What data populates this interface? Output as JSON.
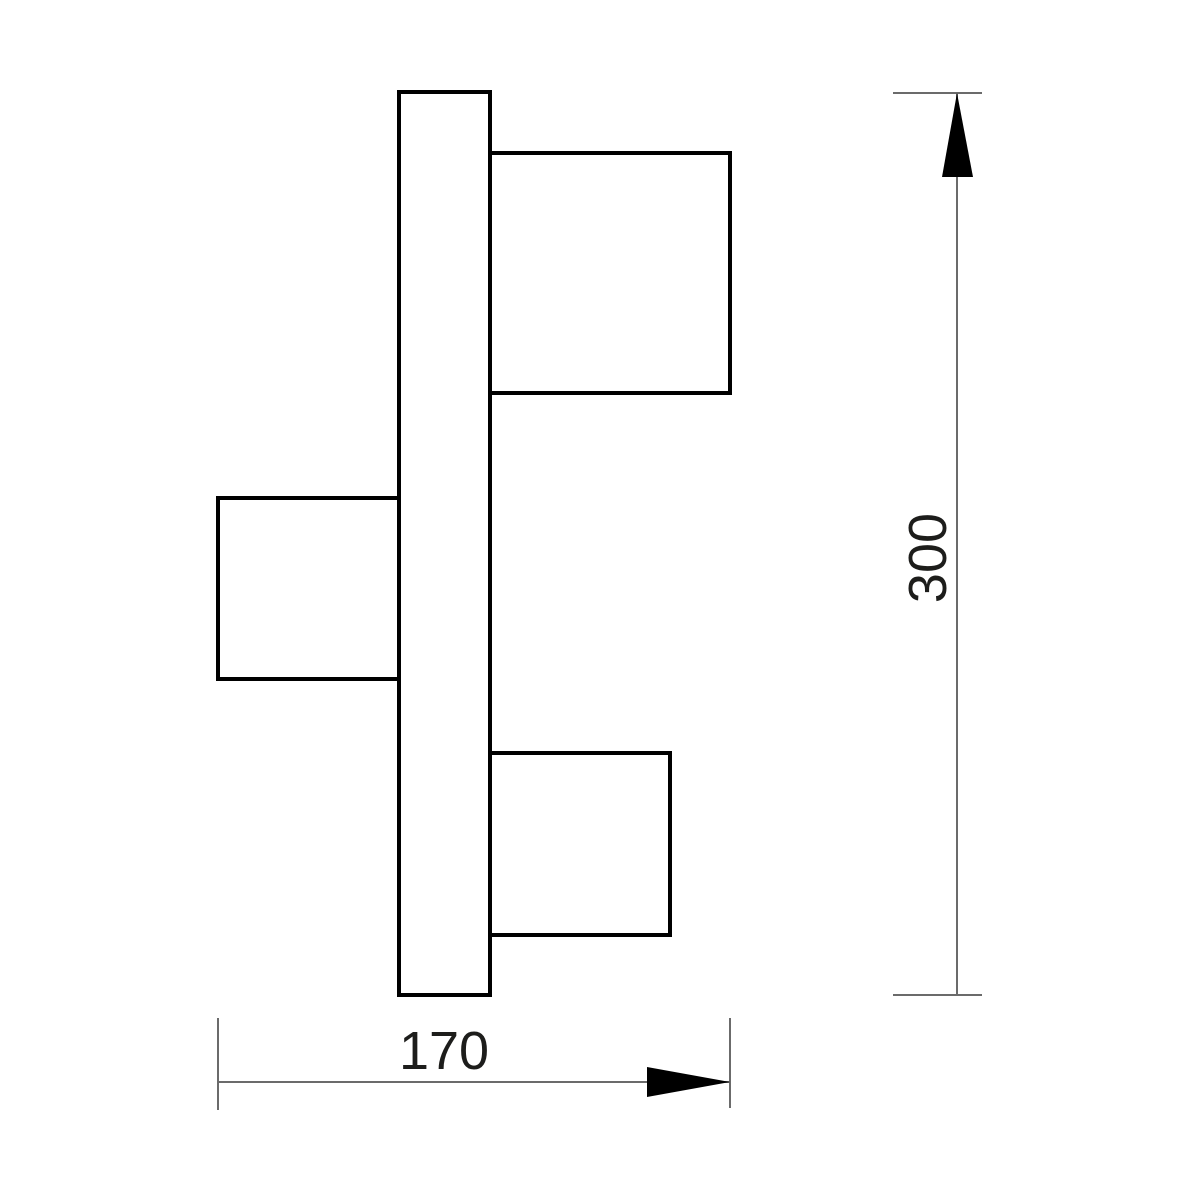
{
  "diagram": {
    "description": "technical-dimension-drawing-three-head-wall-lamp-side-view",
    "canvas": {
      "width": 1200,
      "height": 1200,
      "background": "#ffffff"
    },
    "style": {
      "shape_stroke": "#000000",
      "shape_stroke_width": 4,
      "shape_fill": "#ffffff",
      "dim_line_color": "#6b6b6b",
      "dim_line_width": 2,
      "arrow_fill": "#000000",
      "text_color": "#1d1d1b",
      "font_size": 54
    },
    "shapes": [
      {
        "name": "mounting-bar",
        "x": 399,
        "y": 92,
        "width": 91,
        "height": 903
      },
      {
        "name": "lamp-head-top-right",
        "x": 490,
        "y": 153,
        "width": 240,
        "height": 240
      },
      {
        "name": "lamp-head-middle-left",
        "x": 218,
        "y": 498,
        "width": 181,
        "height": 181
      },
      {
        "name": "lamp-head-bottom-right",
        "x": 490,
        "y": 753,
        "width": 180,
        "height": 182
      }
    ],
    "dimensions": [
      {
        "name": "height-dimension",
        "label": "300",
        "orientation": "vertical",
        "line": {
          "x1": 957,
          "y1": 93,
          "x2": 957,
          "y2": 995
        },
        "ticks": [
          {
            "x1": 893,
            "y1": 93,
            "x2": 982,
            "y2": 93
          },
          {
            "x1": 893,
            "y1": 995,
            "x2": 982,
            "y2": 995
          }
        ],
        "arrow_points": "957,93 942,177 973,177",
        "label_pos": {
          "x": 928,
          "y": 558,
          "rotate": -90
        }
      },
      {
        "name": "width-dimension",
        "label": "170",
        "orientation": "horizontal",
        "line": {
          "x1": 218,
          "y1": 1082,
          "x2": 730,
          "y2": 1082
        },
        "ticks": [
          {
            "x1": 218,
            "y1": 1018,
            "x2": 218,
            "y2": 1110
          },
          {
            "x1": 730,
            "y1": 1018,
            "x2": 730,
            "y2": 1108
          }
        ],
        "arrow_points": "730,1082 647,1067 647,1097",
        "label_pos": {
          "x": 444,
          "y": 1051,
          "rotate": 0
        }
      }
    ]
  }
}
